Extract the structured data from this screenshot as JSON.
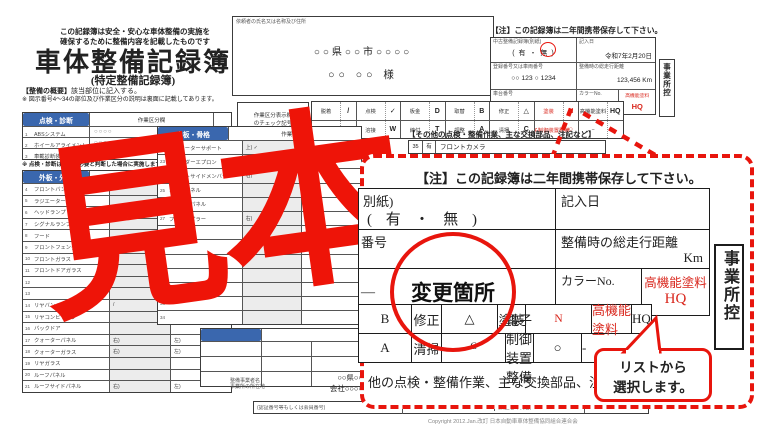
{
  "colors": {
    "accent_red": "#e8150d",
    "header_blue": "#3a67ae",
    "field_red_text": "#d9261c"
  },
  "watermark": "見本",
  "title_block": {
    "slogan_line1": "この記録簿は安全・安心な車体整備の実施を",
    "slogan_line2": "確保するために整備内容を記載したものです",
    "title": "車体整備記録簿",
    "subtitle": "(特定整備記録簿)",
    "overview_label": "【整備の概要】",
    "overview_text": "該当部位に記入する。",
    "note": "※ 図示番号4〜34の部位及び作業区分の説明は裏面に記載してあります。"
  },
  "customer_box": {
    "label": "依頼者の氏名又は名称及び住所",
    "address": "○○県○○市○○○○",
    "name": "○○ ○○ 様"
  },
  "header_right": {
    "keep_note": "【注】この記録簿は二年間携帯保存して下さい。",
    "used_record_label": "中古整備記録簿(別紙)",
    "used_record_options": "( 有 ・ 無 )",
    "entry_date_label": "記入日",
    "entry_date": "令和7年2月20日",
    "reg_no_label": "登録番号又は車両番号",
    "reg_no": "○○ 123 ○ 1234",
    "mileage_label": "整備時の総走行距離",
    "mileage": "123,456",
    "mileage_unit": "Km",
    "chassis_label": "車台番号",
    "chassis_no": "A123B-00000",
    "color_label": "カラーNo.",
    "color_no": "000",
    "paint_label": "高機能塗料",
    "paint_value": "HQ",
    "copy_tab": "事業所控"
  },
  "legend": {
    "label_line1": "作業区分表示欄",
    "label_line2": "のチェック記号",
    "row1": [
      {
        "l": "脱着",
        "s": "/"
      },
      {
        "l": "点検",
        "s": "✓"
      },
      {
        "l": "板金",
        "s": "D"
      },
      {
        "l": "取替",
        "s": "B"
      },
      {
        "l": "修正",
        "s": "△"
      },
      {
        "l": "塗装",
        "s": "N"
      },
      {
        "l": "高機能塗料",
        "s": "HQ"
      }
    ],
    "row2": [
      {
        "l": "交換",
        "s": "X"
      },
      {
        "l": "溶接",
        "s": "W"
      },
      {
        "l": "締付",
        "s": "T"
      },
      {
        "l": "調整",
        "s": "A"
      },
      {
        "l": "清掃",
        "s": "C"
      },
      {
        "l": "電子制御装置整備",
        "s": "○"
      },
      {
        "l": "−",
        "s": ""
      }
    ]
  },
  "others_section": {
    "heading": "【その他の点検・整備作業、主な交換部品、注記など】",
    "row_no": "35",
    "row_mark": "有",
    "row_label": "フロントカメラ"
  },
  "inspection": {
    "header": "点検・診断",
    "col_header": "作業区分欄",
    "rows": [
      {
        "no": "1",
        "label": "ABSシステム",
        "value": "○○○○",
        "check": "✓"
      },
      {
        "no": "2",
        "label": "ホイールアライメント",
        "value": "○○○○",
        "check": "✓"
      },
      {
        "no": "3",
        "label": "車載診断装置",
        "value": "○○○○",
        "check": "✓"
      }
    ],
    "note": "※ 点検・診断は整備に必要と判断した場合に実施します。"
  },
  "outer_panel": {
    "header": "外板・外装",
    "col_header": "作業区分欄",
    "rows": [
      {
        "no": "4",
        "label": "フロントバンパー",
        "m1": "B",
        "m2": ""
      },
      {
        "no": "5",
        "label": "ラジエーターグリル",
        "m1": "",
        "m2": ""
      },
      {
        "no": "6",
        "label": "ヘッドランプ",
        "m1": "",
        "m2": ""
      },
      {
        "no": "7",
        "label": "シグナルランプ",
        "m1": "",
        "m2": ""
      },
      {
        "no": "8",
        "label": "フード",
        "m1": "",
        "m2": ""
      },
      {
        "no": "9",
        "label": "フロントフェンダー",
        "m1": "",
        "m2": ""
      },
      {
        "no": "10",
        "label": "フロントガラス",
        "m1": "",
        "m2": ""
      },
      {
        "no": "11",
        "label": "フロントドアガラス",
        "m1": "",
        "m2": ""
      },
      {
        "no": "12",
        "label": "",
        "m1": "",
        "m2": ""
      },
      {
        "no": "13",
        "label": "",
        "m1": "",
        "m2": ""
      },
      {
        "no": "14",
        "label": "リヤバンパー",
        "m1": "/",
        "m2": ""
      },
      {
        "no": "15",
        "label": "リヤコンビランプ",
        "m1": "",
        "m2": ""
      },
      {
        "no": "16",
        "label": "バックドア",
        "m1": "",
        "m2": ""
      },
      {
        "no": "17",
        "label": "クォーターパネル",
        "m1": "右)",
        "m2": "左)"
      },
      {
        "no": "18",
        "label": "クォーターガラス",
        "m1": "右)",
        "m2": "左)"
      },
      {
        "no": "19",
        "label": "リヤガラス",
        "m1": "",
        "m2": ""
      },
      {
        "no": "20",
        "label": "ルーフパネル",
        "m1": "",
        "m2": ""
      },
      {
        "no": "21",
        "label": "ルーフサイドパネル",
        "m1": "右)",
        "m2": "左)"
      }
    ]
  },
  "inner_panel": {
    "header": "内板・骨格",
    "col_header": "作業区分欄",
    "rows": [
      {
        "no": "22",
        "label": "ラジエーターサポート",
        "m1": "上) ✓",
        "m2": "下) ✓"
      },
      {
        "no": "23",
        "label": "フェンダーエプロン",
        "m1": "右)",
        "m2": "左)"
      },
      {
        "no": "24",
        "label": "フロントサイドメンバー",
        "m1": "右)",
        "m2": "左)"
      },
      {
        "no": "25",
        "label": "カウルパネル",
        "m1": "",
        "m2": ""
      },
      {
        "no": "26",
        "label": "ダッシュパネル",
        "m1": "",
        "m2": ""
      },
      {
        "no": "27",
        "label": "フロントピラー",
        "m1": "右)",
        "m2": "左)"
      },
      {
        "no": "28",
        "label": "",
        "m1": "",
        "m2": ""
      },
      {
        "no": "29",
        "label": "",
        "m1": "",
        "m2": ""
      },
      {
        "no": "30",
        "label": "",
        "m1": "",
        "m2": ""
      },
      {
        "no": "31",
        "label": "",
        "m1": "",
        "m2": ""
      },
      {
        "no": "32",
        "label": "",
        "m1": "",
        "m2": ""
      },
      {
        "no": "33",
        "label": "",
        "m1": "",
        "m2": ""
      },
      {
        "no": "34",
        "label": "",
        "m1": "",
        "m2": ""
      }
    ]
  },
  "footer": {
    "biz_label_line1": "整備事業者名",
    "biz_label_line2": "事業所の所在地",
    "biz_line1": "○○県○○",
    "biz_line2": "会社○○○○",
    "cert_label": "(認証番号等もしくは会員番号)",
    "cert_no": "0 1 - 1 2 3 4",
    "inspector_label": "(検査者の氏名)",
    "copyright": "Copyright 2012.Jan.改訂 日本自動車車体整備協同組合連合会"
  },
  "callout": {
    "keep_note": "【注】この記録簿は二年間携帯保存して下さい。",
    "r1_left_label": "別紙)",
    "r1_left_value": "( 有 ・ 無 )",
    "r1_right_label": "記入日",
    "r2_left_label": "番号",
    "r2_right_label": "整備時の総走行距離",
    "r2_unit": "Km",
    "r3_left_value": "―",
    "circle_text": "変更箇所",
    "color_label": "カラーNo.",
    "paint_label": "高機能塗料",
    "paint_value": "HQ",
    "copy_tab": "事業所控",
    "legend1": [
      {
        "t": "B"
      },
      {
        "t": "修正"
      },
      {
        "t": "△"
      },
      {
        "t": "塗装"
      },
      {
        "t": "N"
      },
      {
        "t": "高機能塗料"
      },
      {
        "t": "HQ"
      }
    ],
    "legend2": [
      {
        "t": "A"
      },
      {
        "t": "清掃"
      },
      {
        "t": "C"
      },
      {
        "t": "電子制御装置整備"
      },
      {
        "t": "○"
      },
      {
        "t": "-"
      }
    ],
    "bubble_line1": "リストから",
    "bubble_line2": "選択します。",
    "bottom_text": "他の点検・整備作業、主な交換部品、注記など】"
  }
}
